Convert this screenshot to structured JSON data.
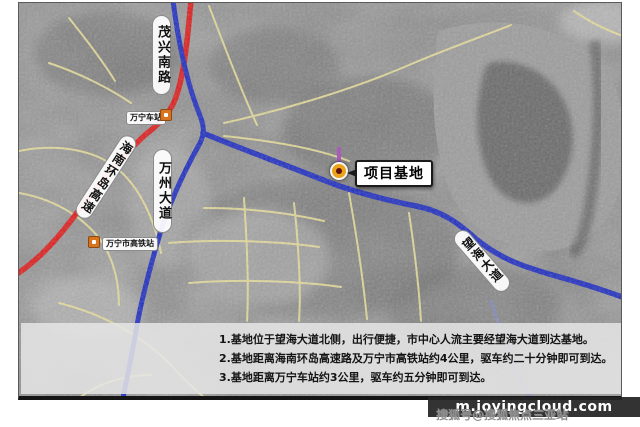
{
  "map": {
    "marker_callout": {
      "label": "项目基地"
    },
    "road_labels": {
      "maoxing_south_road": "茂兴南路",
      "wanning_station": "万宁车站",
      "hainan_ring_expressway": "海南环岛高速",
      "wanzhou_avenue": "万州大道",
      "wanning_hsr_station": "万宁市高铁站",
      "wanghai_avenue": "望海大道"
    },
    "colors": {
      "expressway_red": "#dd1f1f",
      "main_road_blue": "#2230c0",
      "minor_road_yellow": "#e9df9a",
      "marker_orange": "#eca31b",
      "marker_pin_purple": "#a95cba"
    }
  },
  "info_box": {
    "lines": [
      "1.基地位于望海大道北侧，出行便捷，市中心人流主要经望海大道到达基地。",
      "2.基地距离海南环岛高速路及万宁市高铁站约4公里，驱车约二十分钟即可到达。",
      "3.基地距离万宁车站约3公里，驱车约五分钟即可到达。"
    ]
  },
  "watermark": {
    "site": "m.joyingcloud.com",
    "byline": "搜狐号@搜狐焦点三亚站"
  }
}
